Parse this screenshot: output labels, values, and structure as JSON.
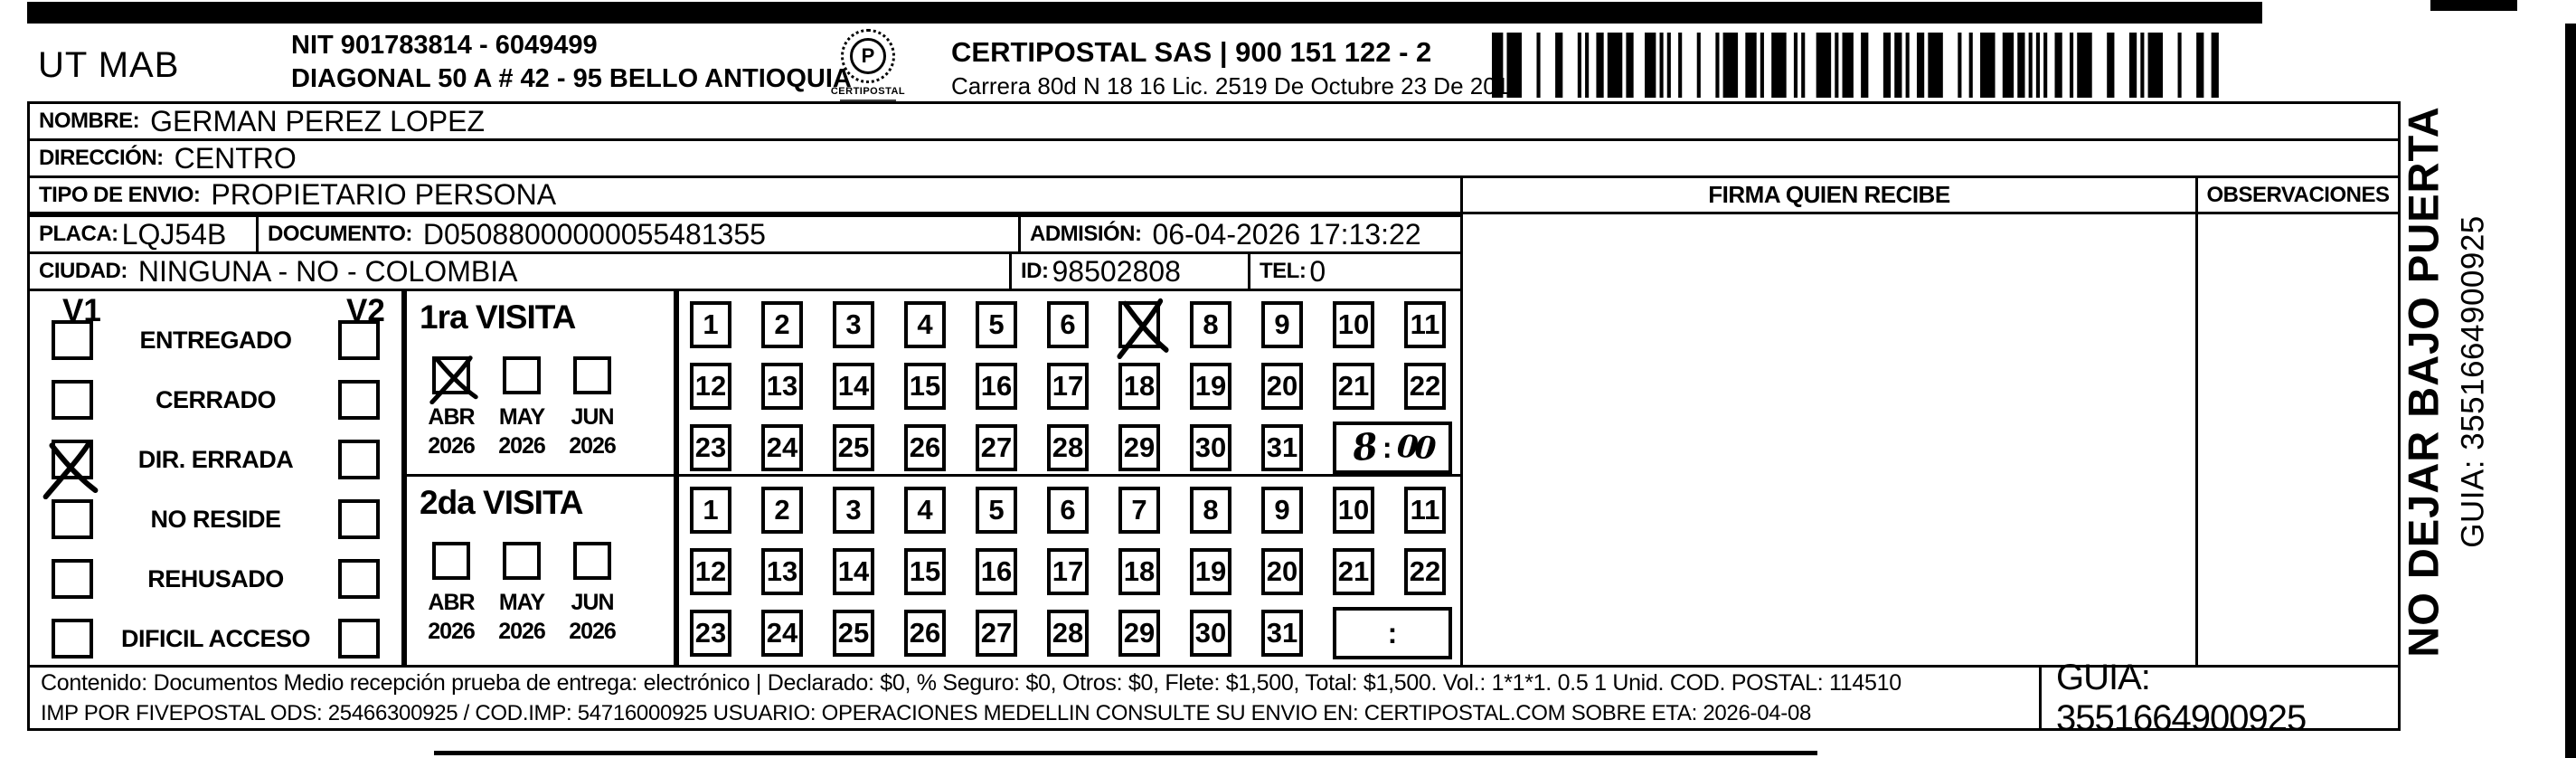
{
  "header": {
    "sender_code": "UT MAB",
    "nit": "NIT 901783814 - 6049499",
    "sender_address": "DIAGONAL 50 A # 42 - 95  BELLO  ANTIOQUIA",
    "logo_name": "CERTIPOSTAL",
    "company": "CERTIPOSTAL SAS | 900 151 122 - 2",
    "company_address": "Carrera 80d N 18 16  Lic. 2519 De Octubre 23 De 2015"
  },
  "shipment": {
    "nombre_label": "NOMBRE:",
    "nombre": "GERMAN PEREZ LOPEZ",
    "direccion_label": "DIRECCIÓN:",
    "direccion": "CENTRO",
    "tipo_envio_label": "TIPO DE ENVIO:",
    "tipo_envio": "PROPIETARIO PERSONA",
    "placa_label": "PLACA:",
    "placa": "LQJ54B",
    "documento_label": "DOCUMENTO:",
    "documento": "D05088000000055481355",
    "admision_label": "ADMISIÓN:",
    "admision": "06-04-2026 17:13:22",
    "ciudad_label": "CIUDAD:",
    "ciudad": "NINGUNA - NO - COLOMBIA",
    "id_label": "ID:",
    "id_value": "98502808",
    "tel_label": "TEL:",
    "tel": "0"
  },
  "visits": {
    "v1_label": "V1",
    "v2_label": "V2",
    "statuses": [
      {
        "label": "ENTREGADO",
        "v1": false,
        "v2": false
      },
      {
        "label": "CERRADO",
        "v1": false,
        "v2": false
      },
      {
        "label": "DIR. ERRADA",
        "v1": true,
        "v2": false
      },
      {
        "label": "NO RESIDE",
        "v1": false,
        "v2": false
      },
      {
        "label": "REHUSADO",
        "v1": false,
        "v2": false
      },
      {
        "label": "DIFICIL ACCESO",
        "v1": false,
        "v2": false
      }
    ],
    "first": {
      "title": "1ra VISITA",
      "months": [
        "ABR",
        "MAY",
        "JUN"
      ],
      "years": [
        "2026",
        "2026",
        "2026"
      ],
      "checked_month": "ABR",
      "day_rows": [
        [
          1,
          2,
          3,
          4,
          5,
          6,
          7,
          8,
          9,
          10,
          11
        ],
        [
          12,
          13,
          14,
          15,
          16,
          17,
          18,
          19,
          20,
          21,
          22
        ],
        [
          23,
          24,
          25,
          26,
          27,
          28,
          29,
          30,
          31
        ]
      ],
      "crossed_day": 7,
      "time_hour": "8",
      "time_minutes": "00",
      "time_separator": ":"
    },
    "second": {
      "title": "2da VISITA",
      "months": [
        "ABR",
        "MAY",
        "JUN"
      ],
      "years": [
        "2026",
        "2026",
        "2026"
      ],
      "checked_month": null,
      "day_rows": [
        [
          1,
          2,
          3,
          4,
          5,
          6,
          7,
          8,
          9,
          10,
          11
        ],
        [
          12,
          13,
          14,
          15,
          16,
          17,
          18,
          19,
          20,
          21,
          22
        ],
        [
          23,
          24,
          25,
          26,
          27,
          28,
          29,
          30,
          31
        ]
      ],
      "crossed_day": null,
      "time_hour": "",
      "time_minutes": "",
      "time_separator": ":"
    }
  },
  "delivery": {
    "firma_label": "FIRMA QUIEN RECIBE",
    "observaciones_label": "OBSERVACIONES"
  },
  "side_text": {
    "warning": "NO DEJAR BAJO PUERTA",
    "guia": "GUIA: 3551664900925"
  },
  "footer": {
    "line1": "Contenido: Documentos Medio recepción prueba de entrega: electrónico | Declarado: $0, % Seguro: $0, Otros: $0, Flete: $1,500, Total: $1,500. Vol.: 1*1*1. 0.5  1 Unid. COD. POSTAL: 114510",
    "line2": "IMP POR FIVEPOSTAL ODS: 25466300925 / COD.IMP: 54716000925 USUARIO: OPERACIONES MEDELLIN CONSULTE SU ENVIO EN: CERTIPOSTAL.COM SOBRE ETA: 2026-04-08",
    "guia": "GUIA: 3551664900925"
  }
}
